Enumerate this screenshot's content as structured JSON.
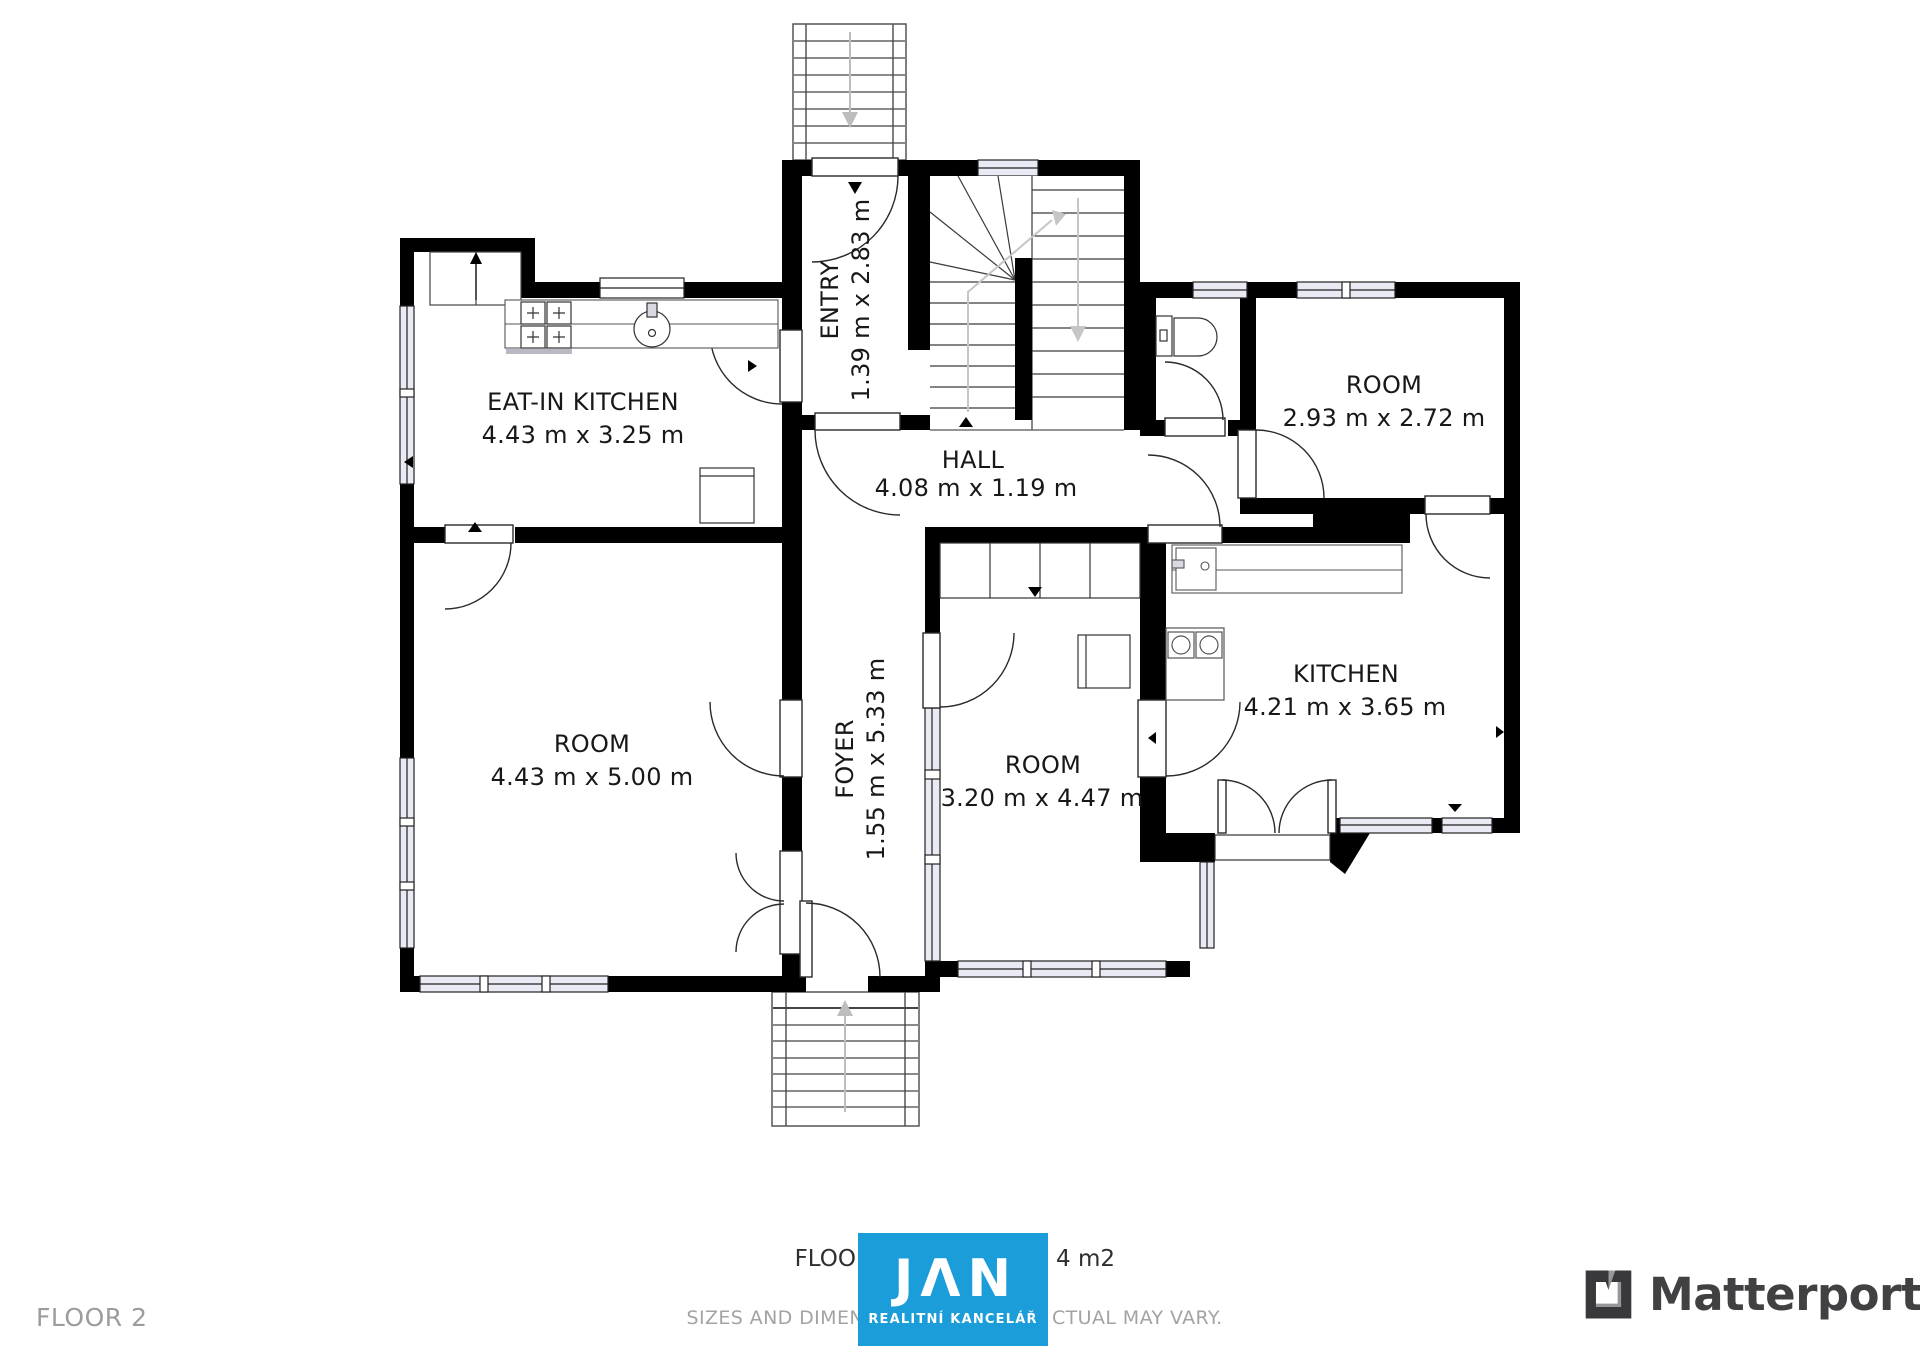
{
  "plan": {
    "rooms": {
      "eat_in_kitchen": {
        "name": "EAT-IN KITCHEN",
        "dims": "4.43 m x 3.25 m"
      },
      "entry": {
        "name": "ENTRY",
        "dims": "1.39 m x 2.83 m"
      },
      "hall": {
        "name": "HALL",
        "dims": "4.08 m x 1.19 m"
      },
      "room_top_right": {
        "name": "ROOM",
        "dims": "2.93 m x 2.72 m"
      },
      "room_left": {
        "name": "ROOM",
        "dims": "4.43 m x 5.00 m"
      },
      "foyer": {
        "name": "FOYER",
        "dims": "1.55 m x 5.33 m"
      },
      "room_middle": {
        "name": "ROOM",
        "dims": "3.20 m x 4.47 m"
      },
      "kitchen": {
        "name": "KITCHEN",
        "dims": "4.21 m x 3.65 m"
      }
    },
    "wall_color": "#000000"
  },
  "footer": {
    "floor_label": "FLOOR 2",
    "area_text_left": "FLOO",
    "area_text_right": "4 m2",
    "disclaimer_left": "SIZES AND DIMEN",
    "disclaimer_right": "CTUAL MAY VARY."
  },
  "branding": {
    "jan": {
      "logo_text": "JΛN",
      "subtitle": "REALITNÍ KANCELÁŘ",
      "color": "#1b9dd9"
    },
    "matterport": {
      "name": "Matterport",
      "text_color": "#414042"
    }
  }
}
